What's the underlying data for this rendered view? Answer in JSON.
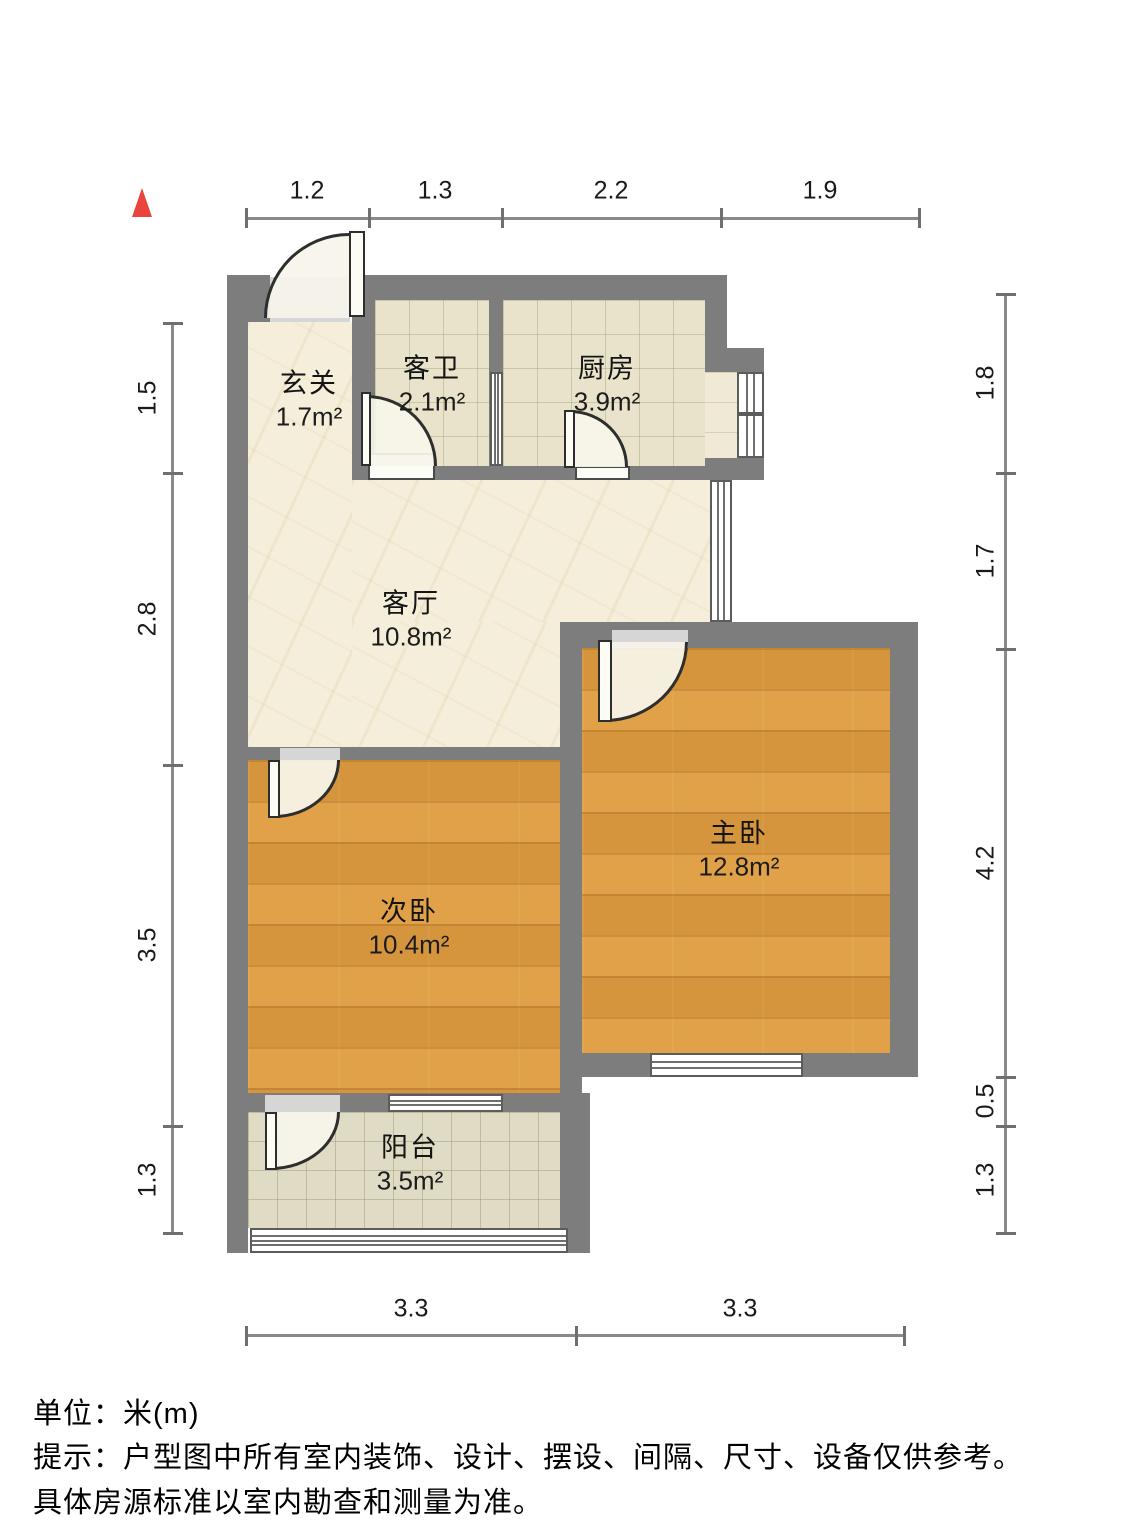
{
  "rooms": [
    {
      "name": "玄关",
      "area": "1.7m²"
    },
    {
      "name": "客卫",
      "area": "2.1m²"
    },
    {
      "name": "厨房",
      "area": "3.9m²"
    },
    {
      "name": "客厅",
      "area": "10.8m²"
    },
    {
      "name": "主卧",
      "area": "12.8m²"
    },
    {
      "name": "次卧",
      "area": "10.4m²"
    },
    {
      "name": "阳台",
      "area": "3.5m²"
    }
  ],
  "dims": {
    "top": [
      "1.2",
      "1.3",
      "2.2",
      "1.9"
    ],
    "left": [
      "1.5",
      "2.8",
      "3.5",
      "1.3"
    ],
    "right": [
      "1.8",
      "1.7",
      "4.2",
      "0.5",
      "1.3"
    ],
    "bottom": [
      "3.3",
      "3.3"
    ]
  },
  "footer": {
    "unit_line": "单位：米(m)",
    "note_line1": "提示：户型图中所有室内装饰、设计、摆设、间隔、尺寸、设备仅供参考。",
    "note_line2": "具体房源标准以室内勘查和测量为准。"
  },
  "colors": {
    "wall": "#7d7d7d",
    "wood_floor": "#df9c40",
    "tile_floor": "#e8e3ca",
    "marble_floor": "#f4eedb",
    "balcony_floor": "#dfdbc4",
    "north_arrow": "#e8463c"
  }
}
